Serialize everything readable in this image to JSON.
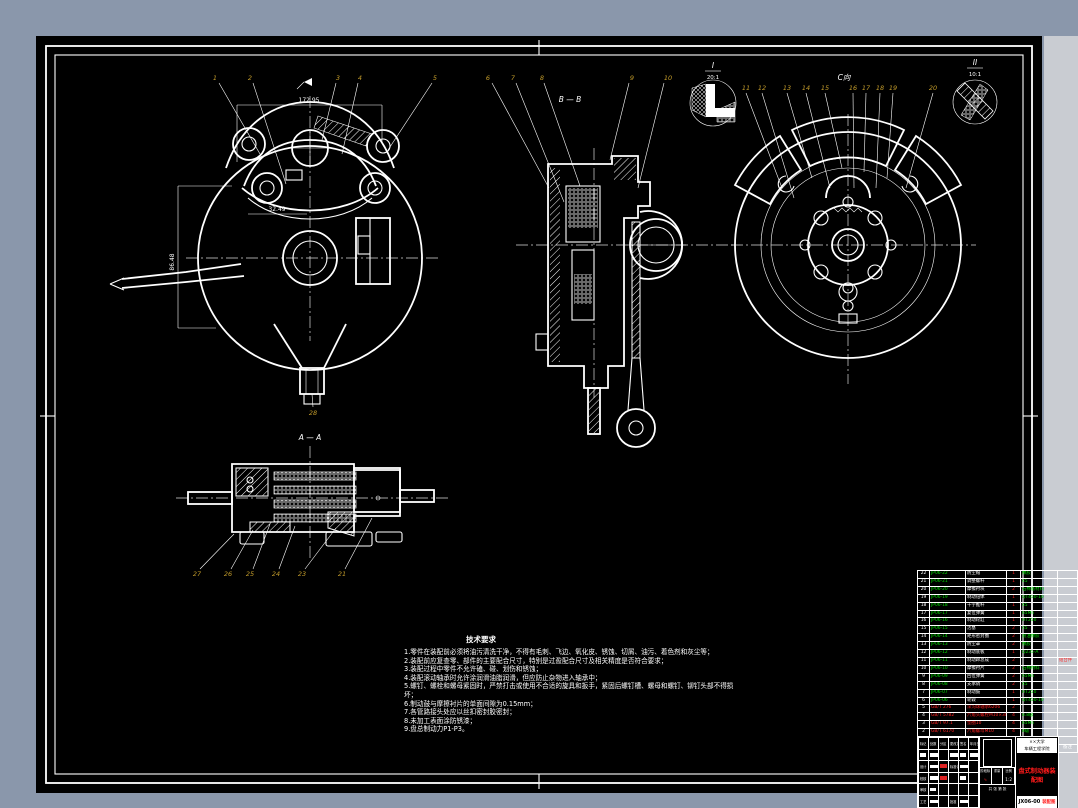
{
  "colors": {
    "frame_blue": "#8a97ab",
    "gutter_gray": "#c9ccd2",
    "sheet_bg": "#000000",
    "line": "#ffffff",
    "balloon_gold": "#c29b2a",
    "bom_green": "#00dd00",
    "bom_red": "#ff2020"
  },
  "views": {
    "front": {
      "balloons": [
        "1",
        "2",
        "3",
        "4",
        "5"
      ],
      "bottom_balloon": "28",
      "dims": {
        "overall": "172.95",
        "offset": "32.49",
        "height": "86.48"
      }
    },
    "section_bb": {
      "label": "B — B",
      "balloons": [
        "6",
        "7",
        "8",
        "9",
        "10"
      ]
    },
    "detail_i": {
      "label": "I",
      "scale": "20:1"
    },
    "rear": {
      "view_label": "C向",
      "balloons": [
        "11",
        "12",
        "13",
        "14",
        "15",
        "16",
        "17",
        "18",
        "19",
        "20"
      ]
    },
    "detail_ii": {
      "label": "II",
      "scale": "10:1"
    },
    "section_aa": {
      "label": "A — A",
      "balloons": [
        "27",
        "26",
        "25",
        "24",
        "23",
        "21"
      ]
    }
  },
  "notes": {
    "title": "技术要求",
    "lines": [
      "1.零件在装配前必须将油污清洗干净，不得有毛刺、飞边、氧化皮、锈蚀、切屑、油污、着色剂和灰尘等；",
      "2.装配前应复查零、部件的主要配合尺寸，特别是过盈配合尺寸及相关精度是否符合要求；",
      "3.装配过程中零件不允许磕、碰、划伤和锈蚀；",
      "4.装配滚动轴承时允许涂润滑油脂润滑，但应防止杂物进入轴承中；",
      "5.螺钉、螺栓和螺母紧固时，严禁打击或使用不合适的旋具和扳手，紧固后螺钉槽、螺母和螺钉、铆钉头部不得损坏；",
      "6.制动鼓与摩擦衬片的单面间隙为0.15mm；",
      "7.各管路接头处应以丝扣密封胶密封；",
      "8.未加工表面涂防锈漆；",
      "9.盘总制动力P1-P3。"
    ]
  },
  "bom": {
    "headers": [
      "序号",
      "代号",
      "名称",
      "数量",
      "材料",
      "备注"
    ],
    "rows": [
      {
        "no": "22",
        "code": "JP06-22",
        "name": "防尘帽",
        "qty": "1",
        "mat": "橡胶",
        "rem": "",
        "cls": ""
      },
      {
        "no": "21",
        "code": "JP06-21",
        "name": "调整螺杆",
        "qty": "1",
        "mat": "45",
        "rem": "",
        "cls": ""
      },
      {
        "no": "20",
        "code": "JP06-20",
        "name": "摩擦衬块",
        "qty": "2",
        "mat": "石棉基材料",
        "rem": "",
        "cls": ""
      },
      {
        "no": "19",
        "code": "JP06-19",
        "name": "制动钳体",
        "qty": "1",
        "mat": "QT450-10",
        "rem": "",
        "cls": ""
      },
      {
        "no": "18",
        "code": "JP06-18",
        "name": "十字推杆",
        "qty": "1",
        "mat": "45",
        "rem": "",
        "cls": ""
      },
      {
        "no": "17",
        "code": "JP06-17",
        "name": "复位弹簧",
        "qty": "1",
        "mat": "65Mn",
        "rem": "",
        "cls": ""
      },
      {
        "no": "16",
        "code": "JP06-16",
        "name": "制动轮缸",
        "qty": "1",
        "mat": "HT250",
        "rem": "",
        "cls": ""
      },
      {
        "no": "15",
        "code": "JP06-15",
        "name": "活塞",
        "qty": "2",
        "mat": "45",
        "rem": "",
        "cls": ""
      },
      {
        "no": "14",
        "code": "JP06-14",
        "name": "矩形密封圈",
        "qty": "2",
        "mat": "耐油橡胶",
        "rem": "",
        "cls": ""
      },
      {
        "no": "13",
        "code": "JP06-13",
        "name": "防尘罩",
        "qty": "2",
        "mat": "橡胶",
        "rem": "",
        "cls": ""
      },
      {
        "no": "12",
        "code": "JP06-12",
        "name": "制动底板",
        "qty": "1",
        "mat": "Q235-A",
        "rem": "",
        "cls": ""
      },
      {
        "no": "11",
        "code": "JP06-11",
        "name": "制动蹄总成",
        "qty": "2",
        "mat": "",
        "rem": "组合件",
        "cls": ""
      },
      {
        "no": "10",
        "code": "JP06-10",
        "name": "摩擦衬片",
        "qty": "2",
        "mat": "石棉材料",
        "rem": "",
        "cls": ""
      },
      {
        "no": "9",
        "code": "JP06-09",
        "name": "回位弹簧",
        "qty": "2",
        "mat": "65Mn",
        "rem": "",
        "cls": ""
      },
      {
        "no": "8",
        "code": "JP06-08",
        "name": "支承销",
        "qty": "2",
        "mat": "45",
        "rem": "",
        "cls": ""
      },
      {
        "no": "7",
        "code": "JP06-07",
        "name": "制动鼓",
        "qty": "1",
        "mat": "HT250",
        "rem": "",
        "cls": ""
      },
      {
        "no": "6",
        "code": "JP06-06",
        "name": "轮毂",
        "qty": "1",
        "mat": "QT450-10",
        "rem": "",
        "cls": ""
      },
      {
        "no": "5",
        "code": "GB/T 276",
        "name": "深沟球轴承6206",
        "qty": "2",
        "mat": "",
        "rem": "",
        "cls": "std"
      },
      {
        "no": "4",
        "code": "GB/T 5782",
        "name": "六角头螺栓M10×30",
        "qty": "4",
        "mat": "8.8级",
        "rem": "",
        "cls": "std"
      },
      {
        "no": "3",
        "code": "GB/T 97.1",
        "name": "垫圈10",
        "qty": "4",
        "mat": "65Mn",
        "rem": "",
        "cls": "std"
      },
      {
        "no": "2",
        "code": "GB/T 6170",
        "name": "六角螺母M10",
        "qty": "4",
        "mat": "8级",
        "rem": "",
        "cls": "std"
      },
      {
        "no": "1",
        "code": "GB/T 827",
        "name": "铆钉3×8",
        "qty": "8",
        "mat": "Q215",
        "rem": "",
        "cls": "std"
      }
    ]
  },
  "title_block": {
    "sig_headers": [
      "标记",
      "处数",
      "分区",
      "更改文件号",
      "签名",
      "年月日"
    ],
    "roles": {
      "design": "设计",
      "check": "校核",
      "review": "审核",
      "process": "工艺",
      "approve": "批准",
      "standard": "标准化"
    },
    "stage_label": "阶段标记",
    "weight_label": "重量",
    "scale_label": "比例",
    "scale_value": "1:2",
    "sheet_info": "共 张 第 张",
    "org_line1": "××大学",
    "org_line2": "车辆工程学院",
    "drawing_title": "盘式制动器装配图",
    "drawing_no": "JX06-00",
    "drawing_no_suffix": "装配图"
  }
}
